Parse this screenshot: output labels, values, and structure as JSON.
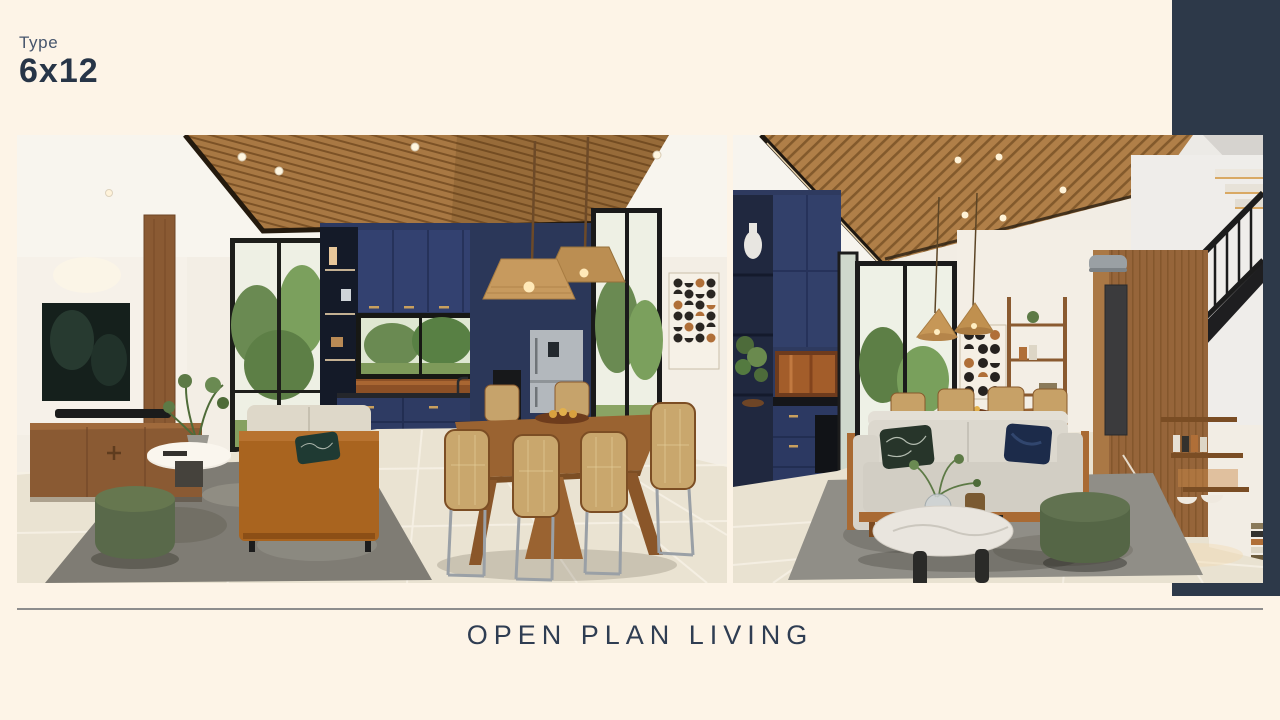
{
  "slide": {
    "background_color": "#fdf4e7",
    "accent_color": "#2d3949",
    "text_color": "#2f3d52",
    "divider_color": "#8d8d8d"
  },
  "header": {
    "type_label": "Type",
    "type_value": "6x12"
  },
  "footer": {
    "title": "OPEN PLAN LIVING"
  },
  "gallery": {
    "left_image_name": "render-kitchen-dining-living",
    "right_image_name": "render-living-staircase",
    "palette": {
      "wood_ceiling": "#a87843",
      "cabinet_navy": "#32406a",
      "pouf_green": "#5a6b4a",
      "sofa_tan": "#a9641f",
      "floor_tile": "#eae3d2"
    }
  }
}
